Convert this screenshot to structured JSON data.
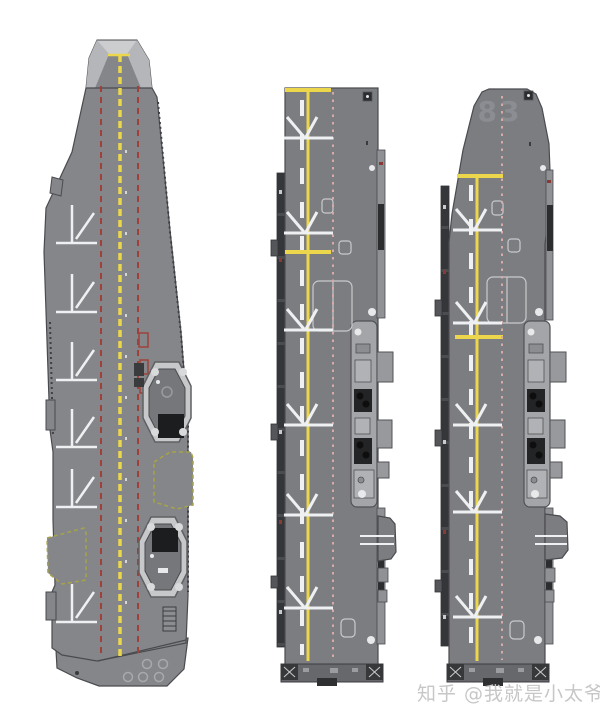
{
  "watermark": {
    "text": "知乎 @我就是小太爷"
  },
  "ships": {
    "left": {
      "markings": {
        "type": "carrier-centerline",
        "yellow": {
          "x": 120,
          "top": 55,
          "bottom": 656,
          "dash": "7 4",
          "width": 3.5
        },
        "red_lines": [
          {
            "x": 101,
            "top": 86,
            "bottom": 653
          },
          {
            "x": 138,
            "top": 86,
            "bottom": 653
          }
        ],
        "white_ticks": {
          "x": 126,
          "top": 150,
          "bottom": 640
        },
        "spots": {
          "style": "hash",
          "ys": [
            243,
            312,
            380,
            447,
            507,
            622
          ]
        }
      }
    },
    "middle": {
      "markings": {
        "type": "runway-line",
        "yellow": {
          "x": 308,
          "top": 88,
          "bottom": 661
        },
        "bars": [
          {
            "y": 90,
            "x1": 285,
            "x2": 331
          },
          {
            "y": 252,
            "x1": 285,
            "x2": 331
          }
        ],
        "white_dash": {
          "x": 302,
          "top": 100,
          "bottom": 655
        },
        "pink": {
          "x": 333,
          "top": 92,
          "bottom": 660
        },
        "spots": {
          "style": "arrow",
          "cx": 305,
          "x1": 284,
          "x2": 333,
          "ys": [
            138,
            233,
            330,
            425,
            515,
            608
          ]
        }
      }
    },
    "right": {
      "hull_number": "83",
      "markings": {
        "type": "runway-line",
        "yellow": {
          "x": 477,
          "top": 174,
          "bottom": 661
        },
        "bars": [
          {
            "y": 176,
            "x1": 457,
            "x2": 503
          },
          {
            "y": 337,
            "x1": 455,
            "x2": 503
          }
        ],
        "white_dash": {
          "x": 471,
          "top": 185,
          "bottom": 655
        },
        "pink": {
          "x": 502,
          "top": 96,
          "bottom": 660
        },
        "spots": {
          "style": "arrow",
          "cx": 474,
          "x1": 453,
          "x2": 502,
          "ys": [
            230,
            323,
            425,
            512,
            617
          ]
        }
      }
    }
  },
  "colors": {
    "background": "#ffffff",
    "deck_left": "#84868a",
    "deck_mid": "#7b7d81",
    "bowcap": "#cbcdcf",
    "bowfacet": "#b4b6b9",
    "edge": "#4a4b4f",
    "yellow": "#ecd64b",
    "red": "#a04038",
    "pink": "#d8aaa6",
    "white": "#eef0f1",
    "olive": "#a8a348",
    "catwalk": "#4b4c4f",
    "strip": "#8f9194",
    "dark": "#2c2d2f",
    "island": "#a3a5a8",
    "funnel": "#232425",
    "elev_frame": "#c6c8ca",
    "elev_inner": "#75777b",
    "elev_dark": "#1c1d1e",
    "stern_band": "#67686c",
    "hull_number_color": "#8f9197",
    "watermark_color": "#c7c7c7",
    "outline_light": "#c9cacc"
  }
}
